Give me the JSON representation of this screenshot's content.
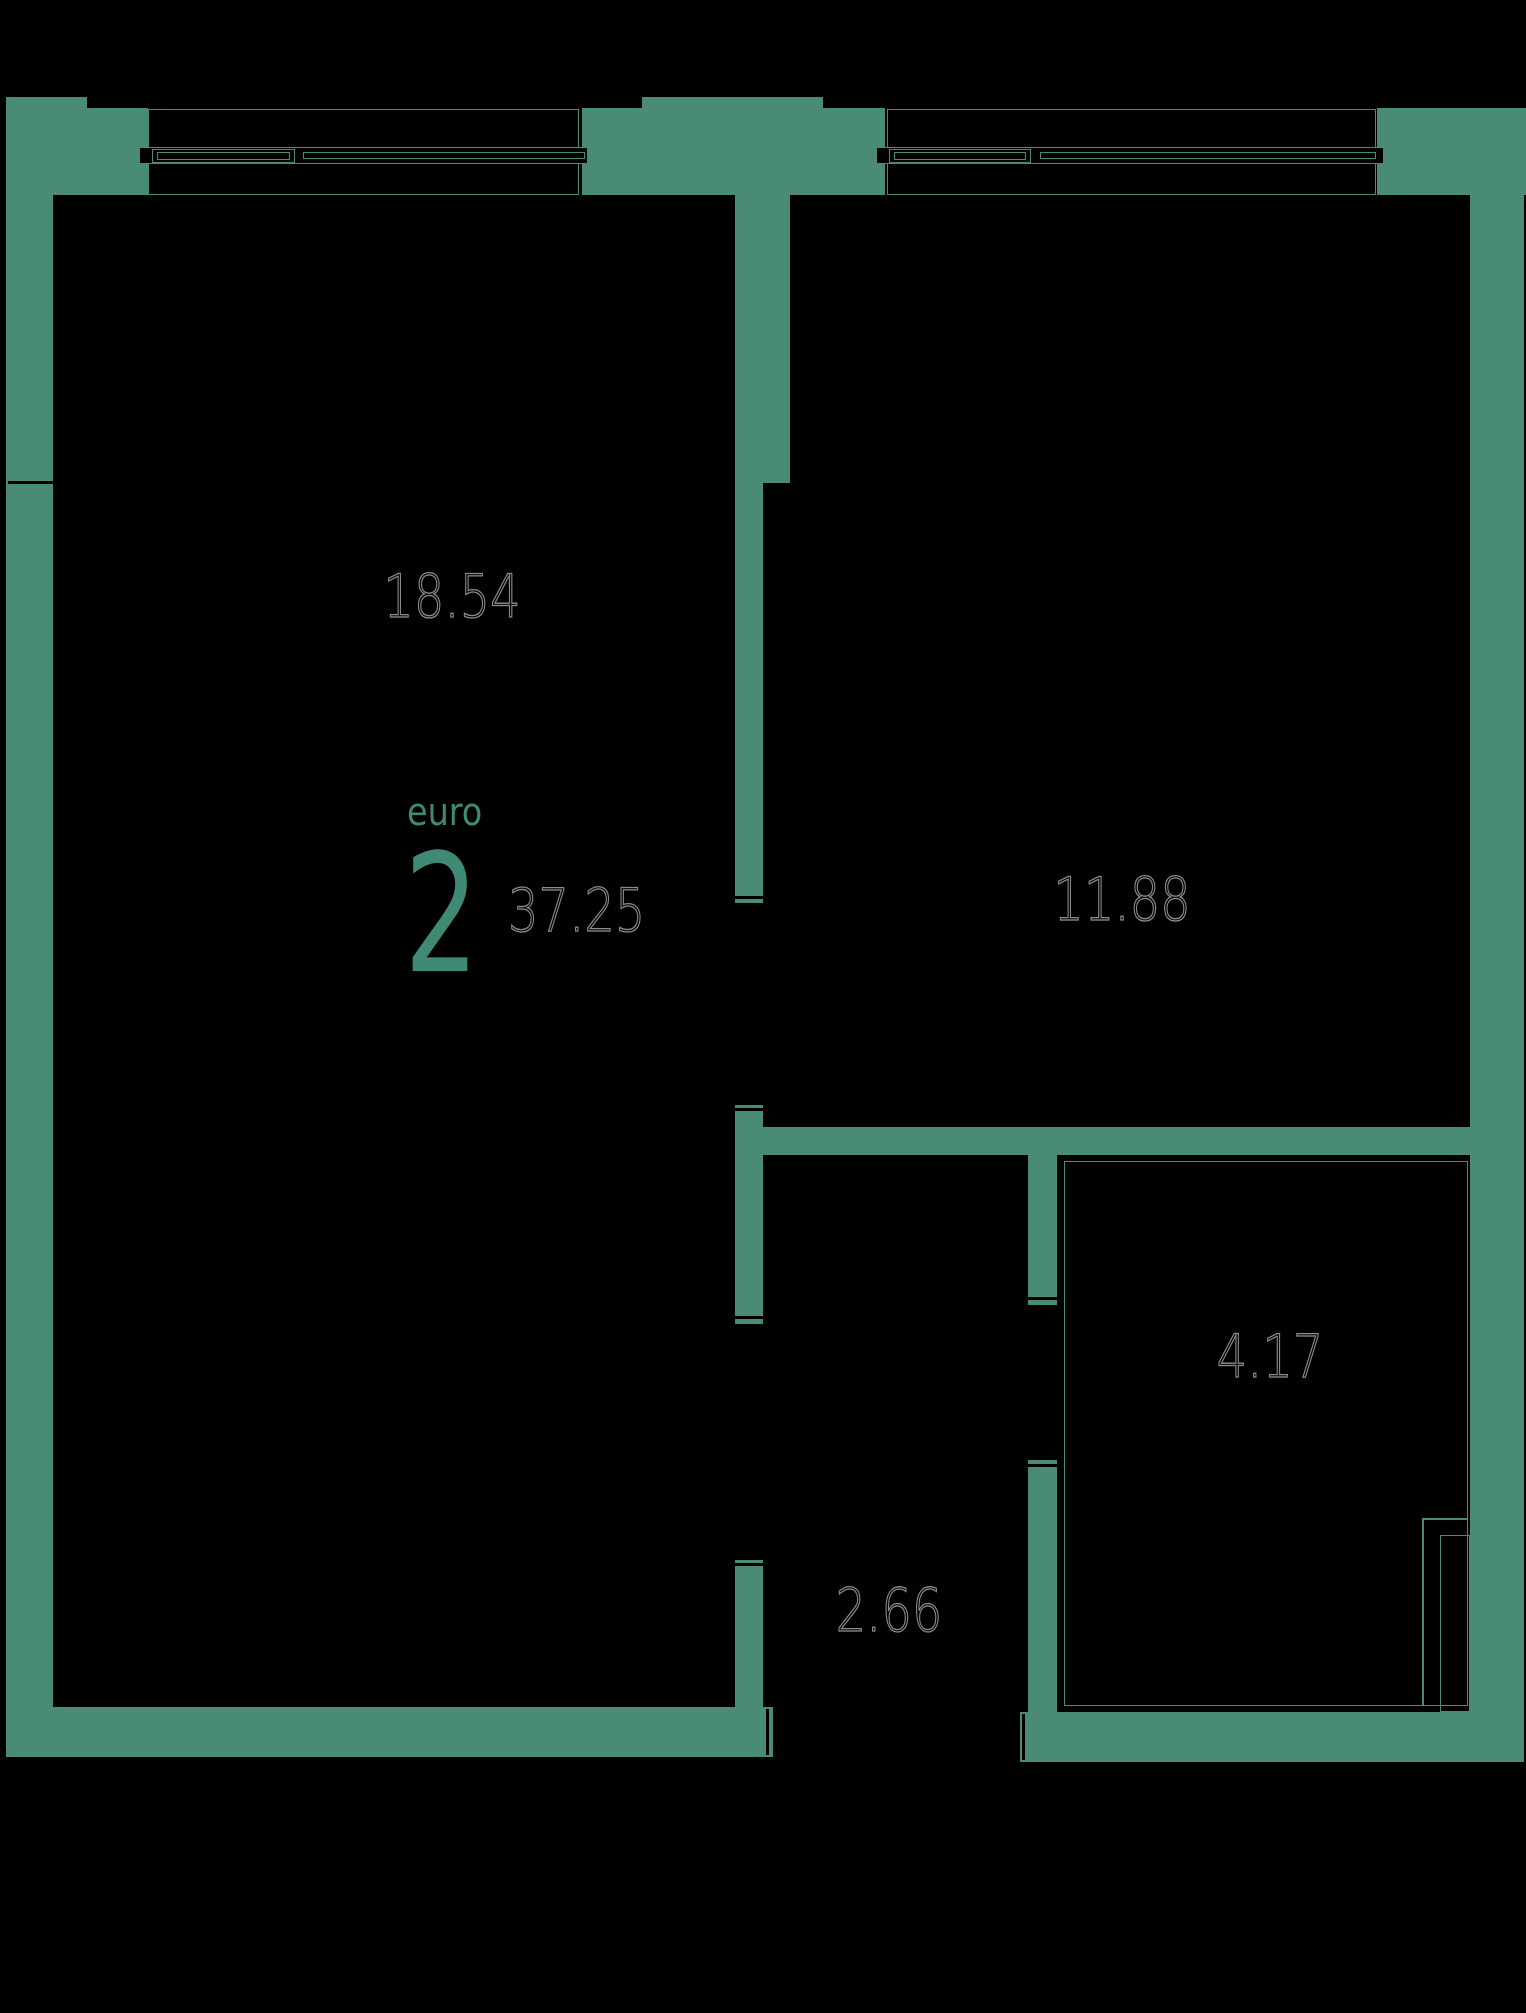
{
  "plan": {
    "unit": {
      "type_label": "euro",
      "rooms_count": "2",
      "total_area": "37.25"
    },
    "rooms": [
      {
        "id": "living-room",
        "area": "18.54"
      },
      {
        "id": "bedroom",
        "area": "11.88"
      },
      {
        "id": "bathroom",
        "area": "4.17"
      },
      {
        "id": "hallway",
        "area": "2.66"
      }
    ],
    "colors": {
      "background": "#000000",
      "wall": "#4A8B78",
      "accent": "#3E8A75",
      "area_outline": "rgba(255,255,255,0.55)"
    }
  }
}
